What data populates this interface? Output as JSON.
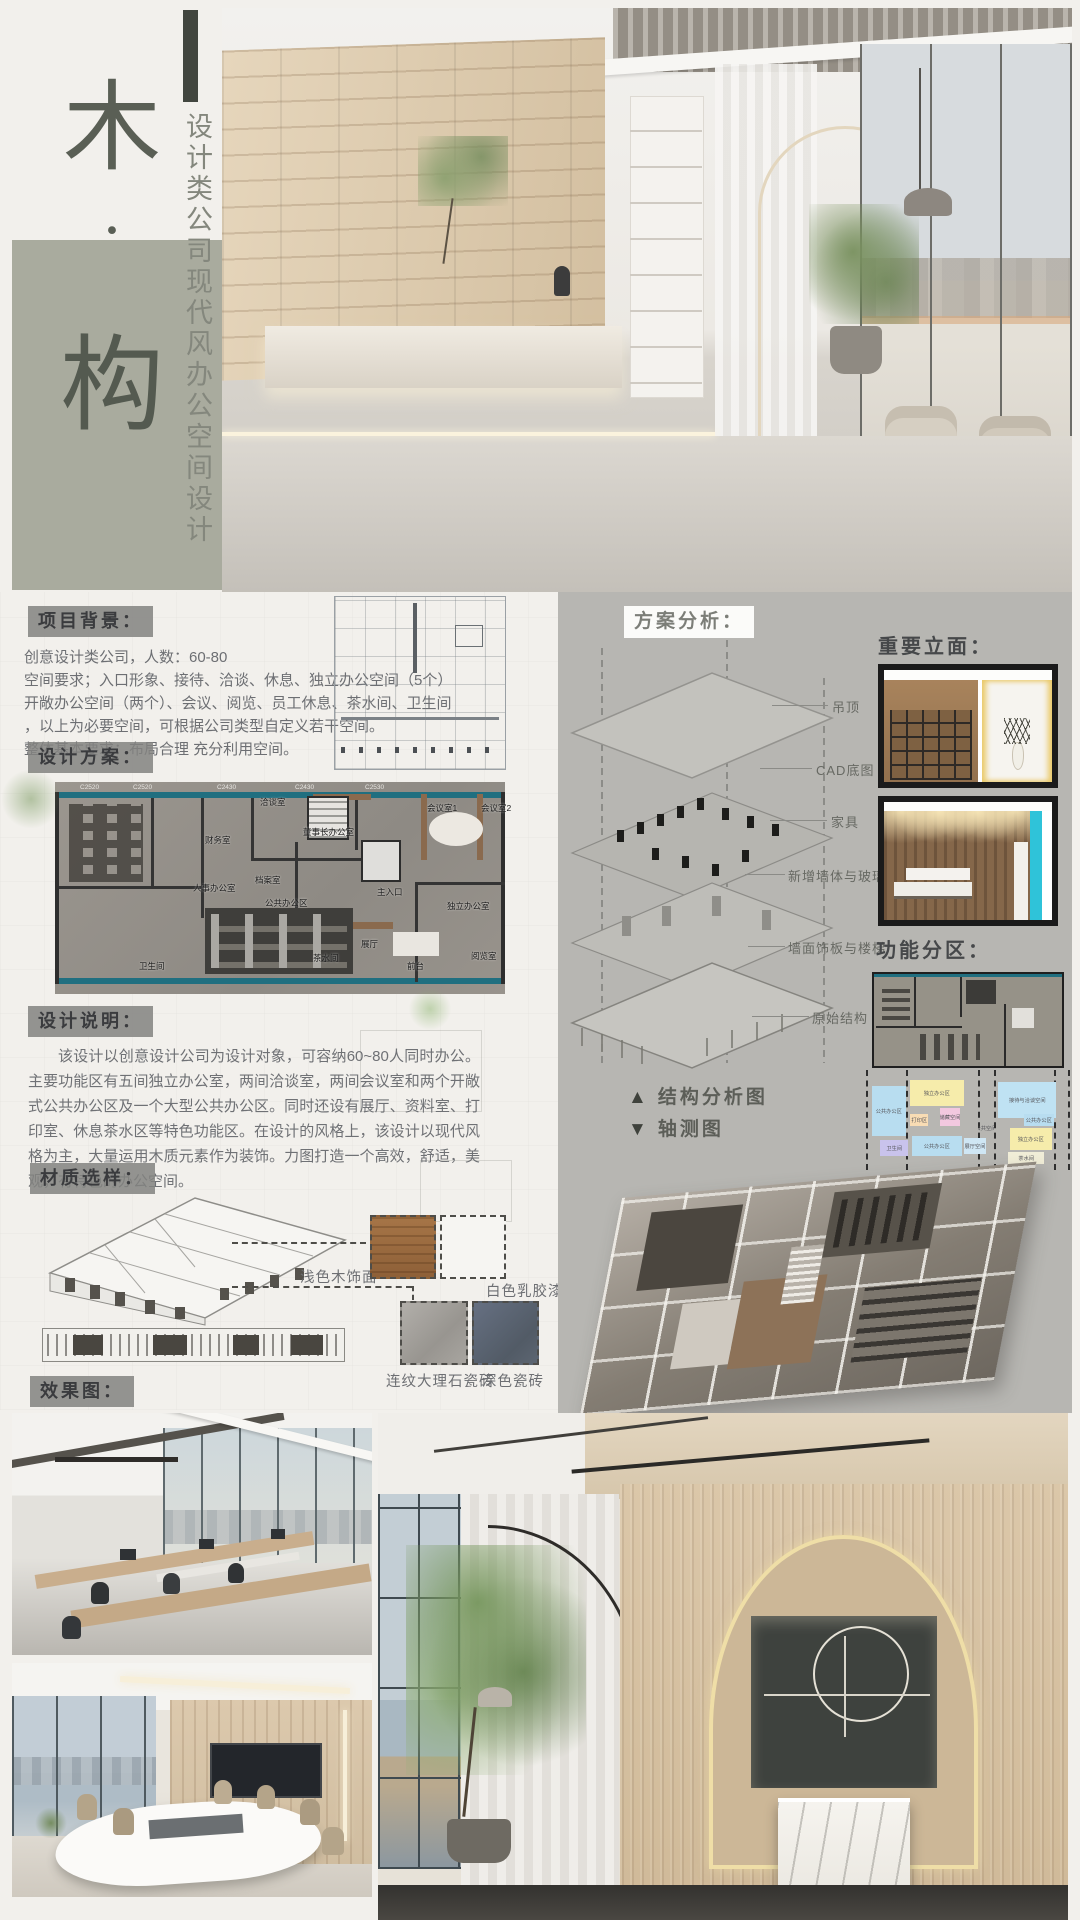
{
  "branding": {
    "title_chars": [
      "木",
      "·",
      "构"
    ],
    "subtitle": "设计类公司现代风办公空间设计",
    "square_color": "#a9ab9e"
  },
  "sections": {
    "project_background": {
      "heading": "项目背景：",
      "lines": [
        "创意设计类公司，人数：60-80",
        "空间要求；入口形象、接待、洽谈、休息、独立办公空间（5个）",
        "开敞办公空间（两个）、会议、阅览、员工休息、茶水间、卫生间",
        "，以上为必要空间，可根据公司类型自定义若干空间。",
        "整体基本要求：布局合理 充分利用空间。"
      ]
    },
    "design_plan": {
      "heading": "设计方案：",
      "dim_labels": [
        "C2520",
        "C2520",
        "C2430",
        "C2430",
        "C2530"
      ],
      "room_labels": [
        "洽谈室",
        "财务室",
        "人事办公室",
        "档案室",
        "董事长办公室",
        "主入口",
        "会议室1",
        "会议室2",
        "公共办公区",
        "展厅",
        "茶水间",
        "前台",
        "独立办公室",
        "阅览室",
        "卫生间"
      ]
    },
    "design_notes": {
      "heading": "设计说明：",
      "text": "该设计以创意设计公司为设计对象，可容纳60~80人同时办公。主要功能区有五间独立办公室，两间洽谈室，两间会议室和两个开敞式公共办公区及一个大型公共办公区。同时还设有展厅、资料室、打印室、休息茶水区等特色功能区。在设计的风格上，该设计以现代风格为主，大量运用木质元素作为装饰。力图打造一个高效，舒适，美观，有特色的办公空间。"
    },
    "materials": {
      "heading": "材质选样：",
      "items": [
        {
          "label": "浅色木饰面",
          "color": "#9a6a42"
        },
        {
          "label": "白色乳胶漆",
          "color": "#f6f5f2"
        },
        {
          "label": "连纹大理石瓷砖",
          "color": "#a5a29d"
        },
        {
          "label": "深色瓷砖",
          "color": "#5c6571"
        }
      ]
    },
    "renders": {
      "heading": "效果图："
    },
    "analysis": {
      "heading": "方案分析：",
      "layer_labels": [
        "吊顶",
        "CAD底图",
        "家具",
        "新增墙体与玻璃",
        "墙面饰板与楼梯",
        "原始结构"
      ],
      "legend": {
        "structure_marker": "▲",
        "structure": "结构分析图",
        "axon_marker": "▼",
        "axonometric": "轴测图"
      }
    },
    "elevations": {
      "heading": "重要立面："
    },
    "zoning": {
      "heading": "功能分区：",
      "zones": [
        {
          "label": "公共办公区",
          "color": "#b8ddf0"
        },
        {
          "label": "独立办公区",
          "color": "#f6ecab"
        },
        {
          "label": "储藏空间",
          "color": "#f2c8df"
        },
        {
          "label": "打印区",
          "color": "#f8dcb4"
        },
        {
          "label": "卫生间",
          "color": "#c9c3ec"
        },
        {
          "label": "公共办公区",
          "color": "#b8ddf0"
        },
        {
          "label": "展厅空间",
          "color": "#cfe6f4"
        },
        {
          "label": "公共空间",
          "color": "transparent"
        },
        {
          "label": "接待与洽谈空间",
          "color": "#bfe2f3"
        },
        {
          "label": "公共办公区",
          "color": "#b8ddf0"
        },
        {
          "label": "独立办公区",
          "color": "#f6ecab"
        },
        {
          "label": "茶水间",
          "color": "#f1eed8"
        }
      ]
    }
  },
  "colors": {
    "page_bg": "#f2f0ec",
    "panel_bg": "#b7b6b2",
    "badge_bg": "#82827e",
    "teal_wall": "#206f80",
    "cyan_accent": "#2fc3d9"
  }
}
